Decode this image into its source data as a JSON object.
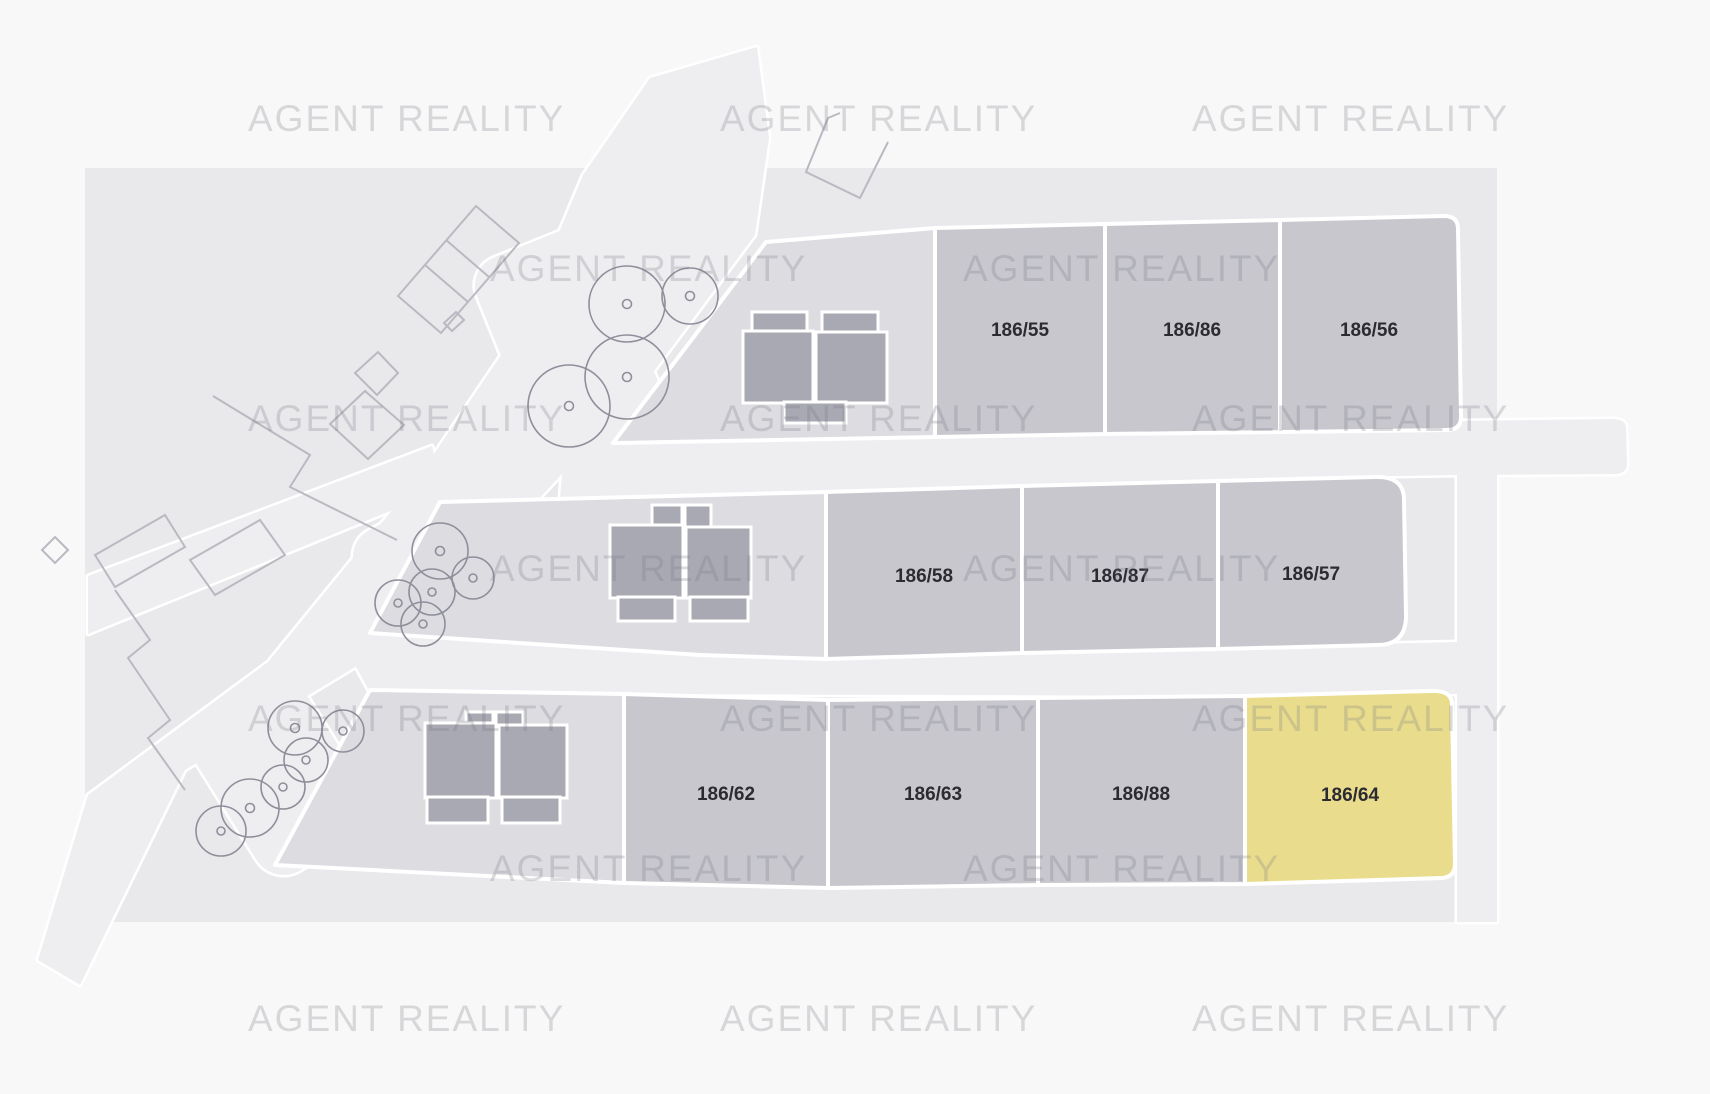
{
  "watermark": {
    "text": "AGENT REALITY"
  },
  "parcels": [
    {
      "id": "186/55",
      "highlighted": false
    },
    {
      "id": "186/86",
      "highlighted": false
    },
    {
      "id": "186/56",
      "highlighted": false
    },
    {
      "id": "186/58",
      "highlighted": false
    },
    {
      "id": "186/87",
      "highlighted": false
    },
    {
      "id": "186/57",
      "highlighted": false
    },
    {
      "id": "186/62",
      "highlighted": false
    },
    {
      "id": "186/63",
      "highlighted": false
    },
    {
      "id": "186/88",
      "highlighted": false
    },
    {
      "id": "186/64",
      "highlighted": true
    }
  ],
  "colors": {
    "background": "#f8f8f9",
    "map_area": "#e9e9ec",
    "road": "#eeeef1",
    "lot": "#c7c7cd",
    "lot_buildings": "#dcdce1",
    "lot_highlight": "#e9dd8d",
    "building": "#a9a9b3",
    "boundary": "#ffffff",
    "tree_outline": "#8f8f9b",
    "neighbor_outline": "#b9b9c1",
    "watermark": "rgba(120,120,132,0.26)",
    "label_text": "#2b2b31"
  }
}
